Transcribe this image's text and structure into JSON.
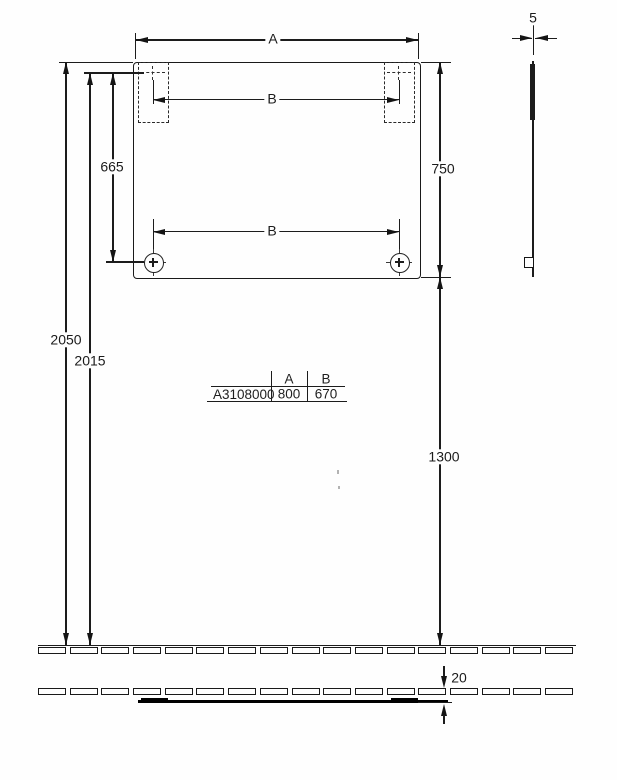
{
  "front_view": {
    "dim_a": "A",
    "dim_b_top": "B",
    "dim_b_bottom": "B",
    "dim_665": "665",
    "dim_750": "750",
    "dim_2050": "2050",
    "dim_2015": "2015",
    "dim_1300": "1300"
  },
  "side_view": {
    "dim_5": "5"
  },
  "bottom_detail": {
    "dim_20": "20"
  },
  "spec_table": {
    "header_a": "A",
    "header_b": "B",
    "row": {
      "model": "A3108000",
      "a_value": "800",
      "b_value": "670"
    }
  }
}
